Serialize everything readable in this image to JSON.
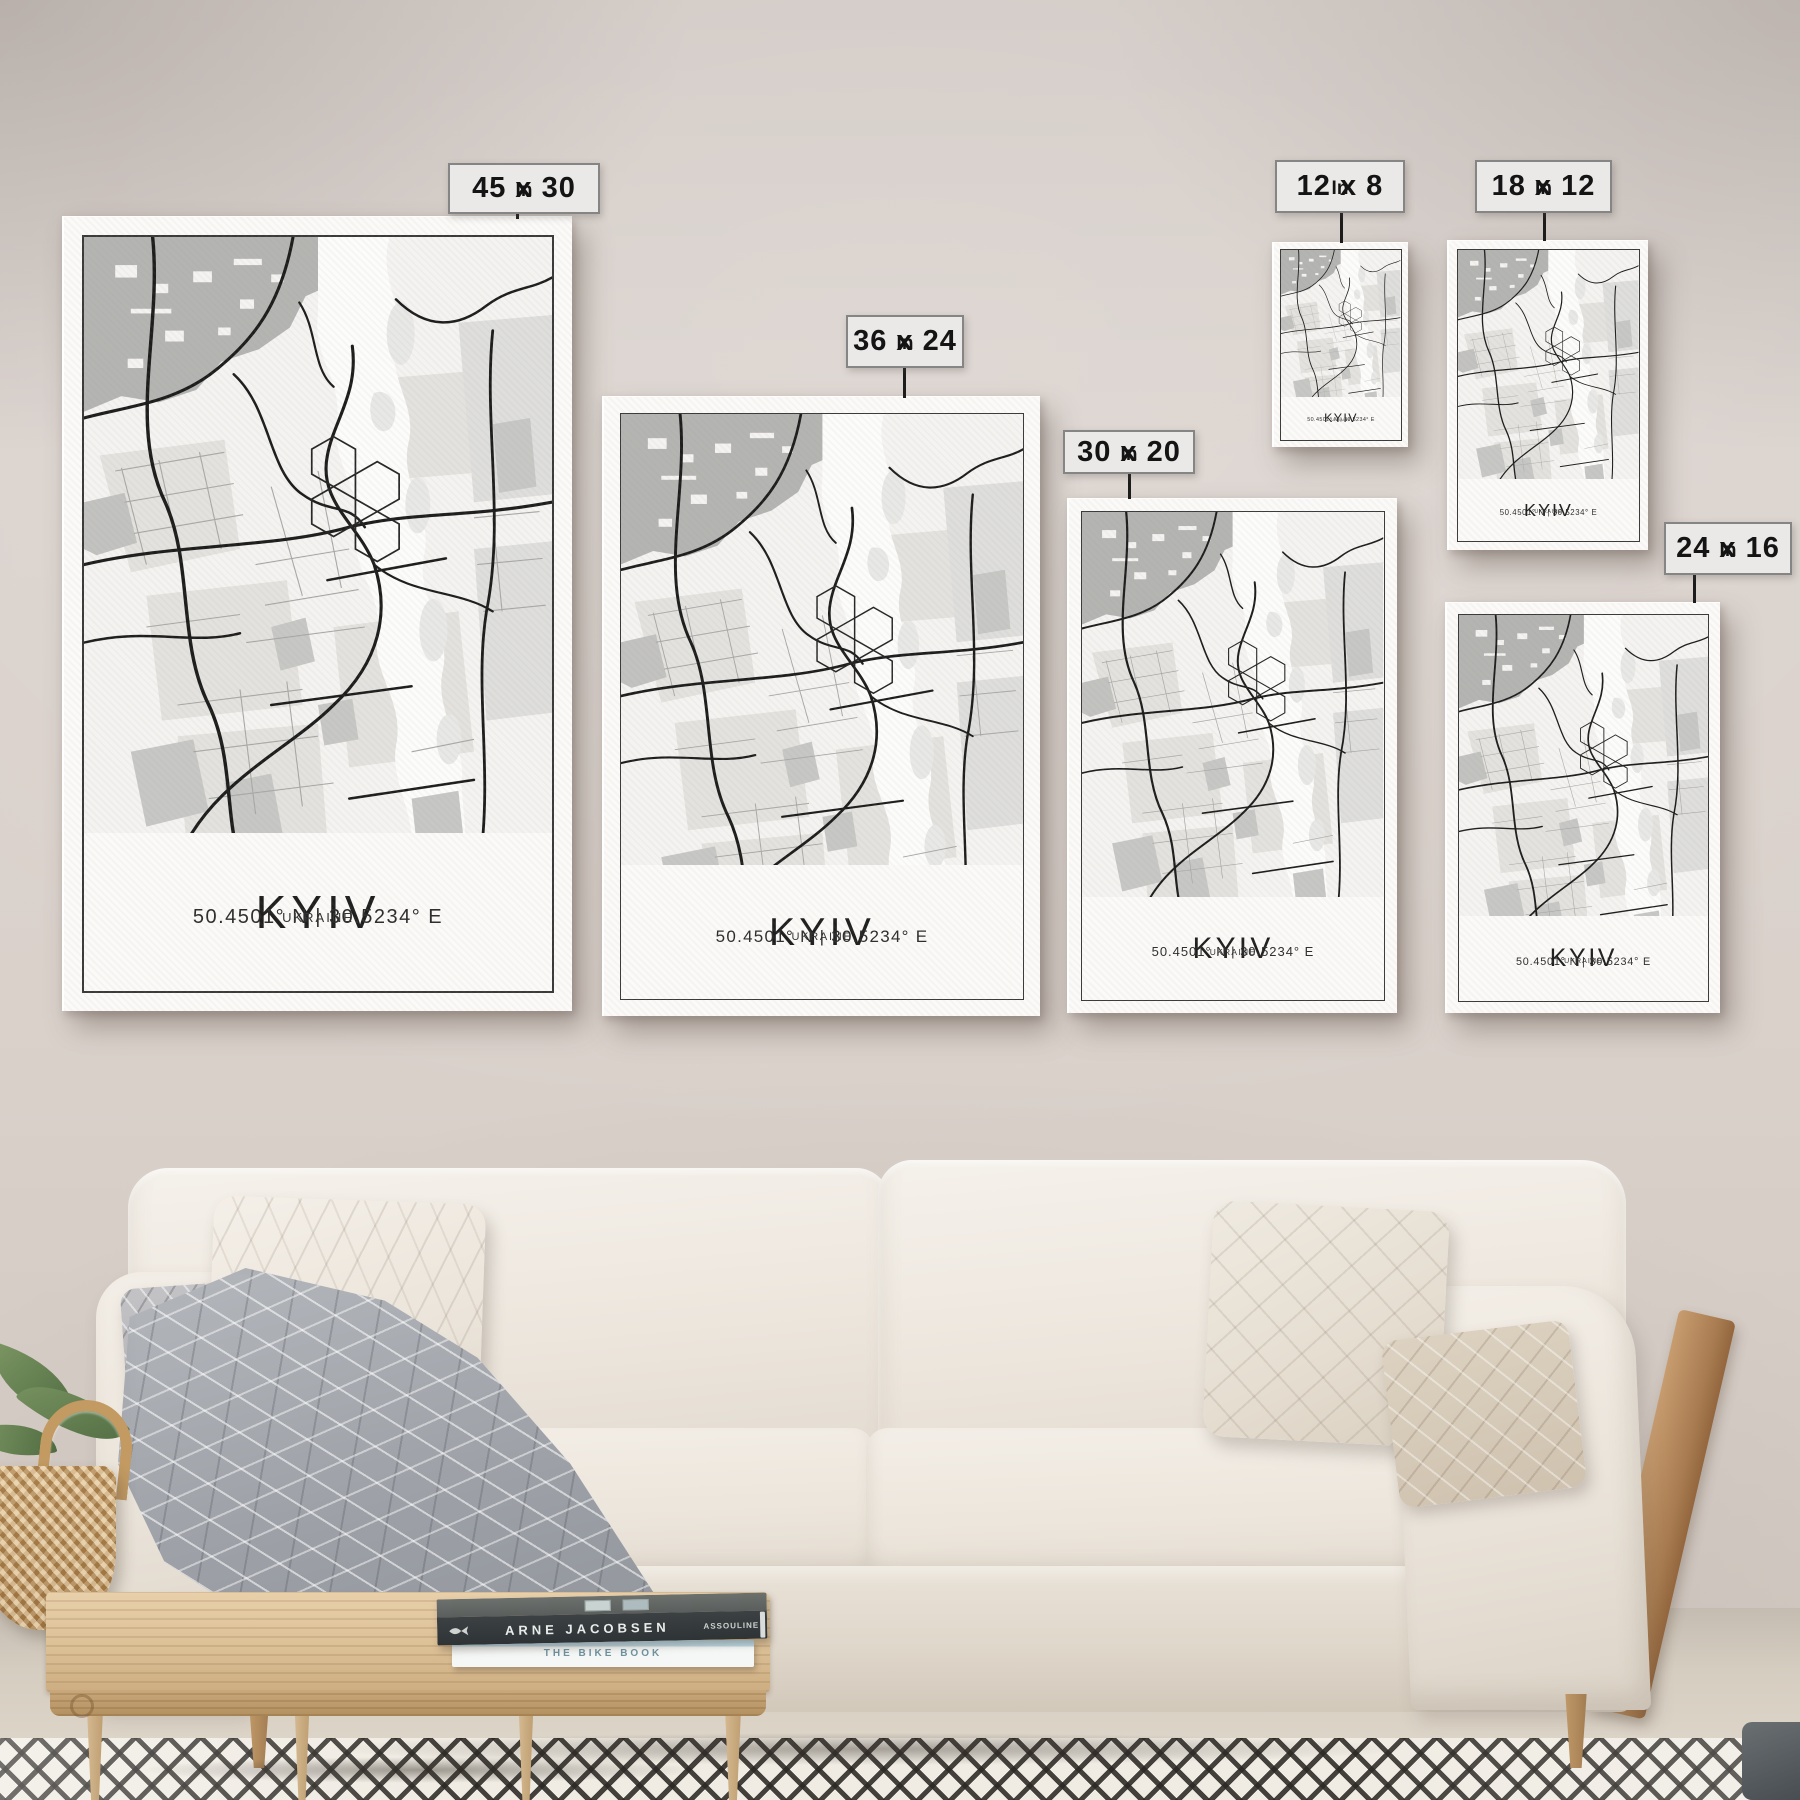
{
  "posters": {
    "title": "KYIV",
    "coordinates": "50.4501° N | 30.5234° E",
    "country": "UKRAINE"
  },
  "size_tags": [
    {
      "size": "45 x 30",
      "unit": "In"
    },
    {
      "size": "36 x 24",
      "unit": "In"
    },
    {
      "size": "30 x 20",
      "unit": "In"
    },
    {
      "size": "12 x 8",
      "unit": "In"
    },
    {
      "size": "18 x 12",
      "unit": "In"
    },
    {
      "size": "24 x 16",
      "unit": "In"
    }
  ],
  "books": {
    "top_title": "ARNE JACOBSEN",
    "top_publisher": "ASSOULINE",
    "bottom_title": "THE BIKE BOOK"
  },
  "colors": {
    "wall": "#d9d1cb",
    "floor": "#d6cdc1",
    "canvas_white": "#fbfaf8",
    "map_ink": "#1d1d1d",
    "map_gray_area": "#b4b4b2",
    "tag_background": "#ebe9e7",
    "tag_border": "#858585",
    "sofa_fabric": "#efe9e0",
    "wood": "#c9a87c"
  }
}
